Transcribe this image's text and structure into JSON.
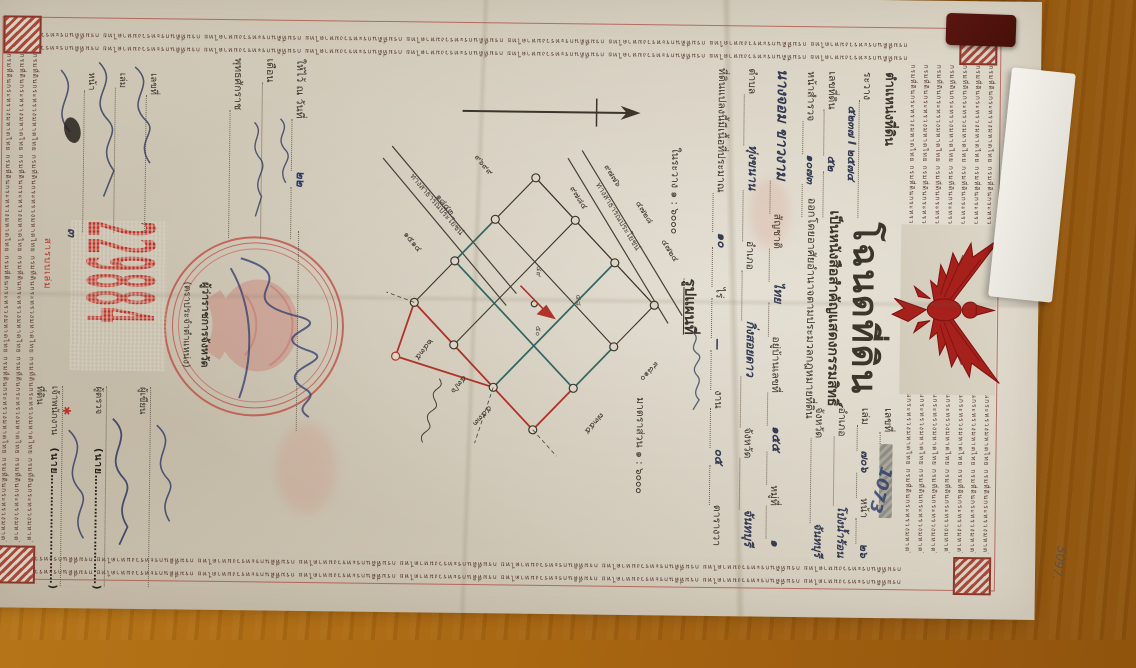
{
  "photo": {
    "pencil_note": "5097."
  },
  "deed": {
    "border_pattern": "กรมที่ดินกระทรวงมหาดไทย",
    "title": "โฉนดที่ดิน",
    "subtitle": "เป็นหนังสือสำคัญแสดงกรรมสิทธิ์",
    "authority_line": "ออกโดยอาศัยอำนาจตามประมวลกฎหมายที่ดิน",
    "position_block": {
      "header": "ตำแหน่งที่ดิน",
      "ravang_label": "ระวาง",
      "ravang_value": "๕๒๓๗ I ๒๕๗๔",
      "parcel_label": "เลขที่ดิน",
      "parcel_value": "๕๒",
      "survey_label": "หน้าสำรวจ",
      "survey_value": "๑๐๗๓"
    },
    "ref_block": {
      "number_label": "เลขที่",
      "volume_label": "เล่ม",
      "volume_value": "๗๐๖",
      "page_label": "หน้า",
      "page_value": "๒๖",
      "amphoe_label": "อำเภอ",
      "amphoe_value": "โป่งน้ำร้อน",
      "province_label": "จังหวัด",
      "province_value": "จันทบุรี",
      "diagonal_note": "1073"
    },
    "holder": {
      "name": "นางจอม ขาวงาม",
      "nationality_label": "สัญชาติ",
      "nationality": "ไทย",
      "address_label": "อยู่บ้านเลขที่",
      "address": "๑๕๕",
      "moo_label": "หมู่ที่",
      "moo": "๑",
      "tambon_label": "ตำบล",
      "tambon": "ทุ่งขนาน",
      "amphoe_label": "อำเภอ",
      "amphoe": "กิ่งสอยดาว",
      "province_label": "จังหวัด",
      "province": "จันทบุรี"
    },
    "area_line": {
      "prefix": "ที่ดินแปลงนี้มีเนื้อที่ประมาณ",
      "rai": "๑๐",
      "rai_label": "ไร่",
      "ngan": "—",
      "ngan_label": "งาน",
      "wa": "๐๕",
      "wa_label": "ตารางวา"
    },
    "map_section": {
      "heading": "รูปแผนที่",
      "ravang_scale": "ในระวาง ๑ : ๖๐๐๐",
      "scale": "มาตราส่วน ๑ : ๖๐๐๐",
      "road_label_1": "ทางสาธารณประโยชน์",
      "road_label_2": "ทางสาธารณประโยชน์",
      "numbers": [
        "๔๗๒๔",
        "๔๗๒๘",
        "๙๗๗๖",
        "๙๗๘๔",
        "๙๘๑๐",
        "๗๓๕๕",
        "๕๕๓๓",
        "๙๖๙๙",
        "๑๘๔๓",
        "๑๕๑๔",
        "๒๔๓๕",
        "๕๓/๖"
      ],
      "cell_numbers": [
        "๔๘",
        "๔๙",
        "๕๐"
      ]
    },
    "issue_line": {
      "prefix": "ให้ไว้ ณ วันที่",
      "day": "๒๒",
      "month_label": "เดือน",
      "year_label": "พุทธศักราช"
    },
    "seal": {
      "caption_main": "ผู้ว่าราชการจังหวัด",
      "caption_sub": "(ตราประจำตำแหน่ง)"
    },
    "signatures": [
      {
        "stamp": "",
        "caption": "ผู้เขียน"
      },
      {
        "stamp": "(นาย…………………………)",
        "caption": "ผู้ตรวจ"
      },
      {
        "stamp": "(นาย…………………………)",
        "caption": "เจ้าพนักงานที่ดิน"
      }
    ],
    "serial": "229884",
    "serial_mark": "๓",
    "serial_star": "✱",
    "registry": {
      "rows": [
        "เลขที่",
        "เล่ม",
        "หน้า"
      ],
      "red_note": "สารบบเล่ม"
    }
  }
}
